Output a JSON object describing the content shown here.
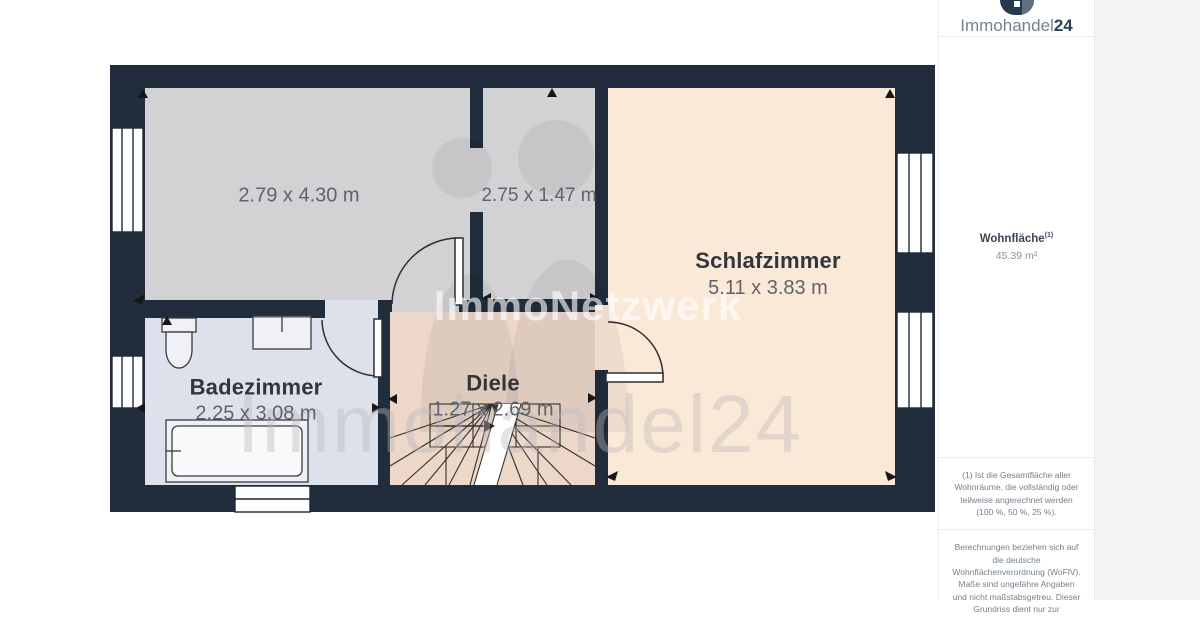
{
  "logo": {
    "name_light": "Immohandel",
    "name_bold": "24"
  },
  "sidebar": {
    "area_title": "Wohnfläche",
    "area_sup": "(1)",
    "area_value": "45.39 m²",
    "footnote_area": "(1) Ist die Gesamtfläche aller Wohnräume, die vollständig oder teilweise angerechnet werden (100 %, 50 %, 25 %).",
    "footnote_legal": "Berechnungen beziehen sich auf die deutsche Wohnflächenverordnung (WoFlV). Maße sind ungefähre Angaben und nicht maßstabsgetreu. Dieser Grundriss dient nur zur"
  },
  "floorplan": {
    "rooms": [
      {
        "label": "",
        "dims": "2.79 x 4.30 m"
      },
      {
        "label": "",
        "dims": "2.75 x 1.47 m"
      },
      {
        "label": "Schlafzimmer",
        "dims": "5.11 x 3.83 m"
      },
      {
        "label": "Badezimmer",
        "dims": "2.25 x 3.08 m"
      },
      {
        "label": "Diele",
        "dims": "1.27 x 2.69 m"
      }
    ],
    "colors": {
      "wall": "#212d3c",
      "room_gray": "#d2d2d4",
      "room_peach": "#fbe9d8",
      "room_blue": "#dce1ec",
      "room_pink": "#ecd7c9"
    }
  },
  "watermarks": {
    "center": "ImmoNetzwerk",
    "bottom": "Immohandel24"
  }
}
